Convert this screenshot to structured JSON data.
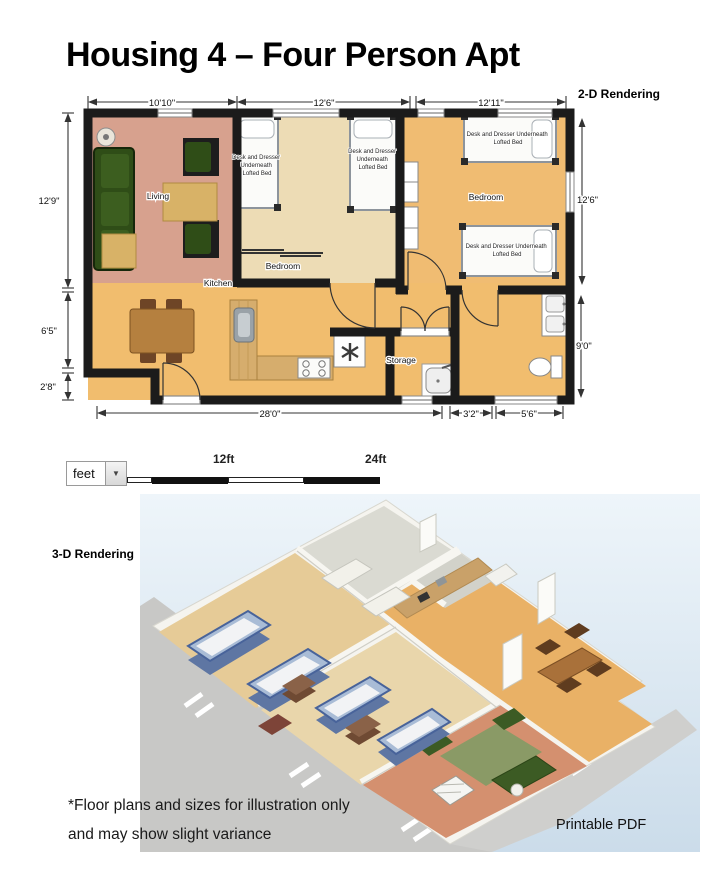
{
  "page": {
    "title": "Housing 4 – Four Person Apt"
  },
  "labels": {
    "rendering_2d": "2-D Rendering",
    "rendering_3d": "3-D Rendering",
    "footnote_line1": "*Floor plans and sizes for illustration only",
    "footnote_line2": "and may show slight variance",
    "printable_pdf": "Printable PDF"
  },
  "floor_plan": {
    "rooms": {
      "living": "Living",
      "bedroom_middle": "Bedroom",
      "bedroom_right": "Bedroom",
      "kitchen": "Kitchen",
      "storage": "Storage"
    },
    "bed_label": {
      "l1": "Desk and Dresser",
      "l2": "Underneath",
      "l3": "Lofted Bed",
      "wide1": "Desk and Dresser Underneath",
      "wide2": "Lofted Bed"
    },
    "dims": {
      "top1": "10'10\"",
      "top2": "12'6\"",
      "top3": "12'11\"",
      "left1": "12'9\"",
      "left2": "6'5\"",
      "left3": "2'8\"",
      "right1": "12'6\"",
      "right2": "9'0\"",
      "bottom1": "28'0\"",
      "bottom2": "3'2\"",
      "bottom3": "5'6\""
    }
  },
  "scale_bar": {
    "unit": "feet",
    "mid": "12ft",
    "end": "24ft",
    "arrow": "▼"
  },
  "colors": {
    "wall": "#1b1b1b",
    "floor_living": "#d7a18e",
    "floor_bedroom_middle": "#eddcb5",
    "floor_orange": "#f1bd6e",
    "sky_top": "#eef5fa",
    "sky_bottom": "#cbdcea"
  }
}
